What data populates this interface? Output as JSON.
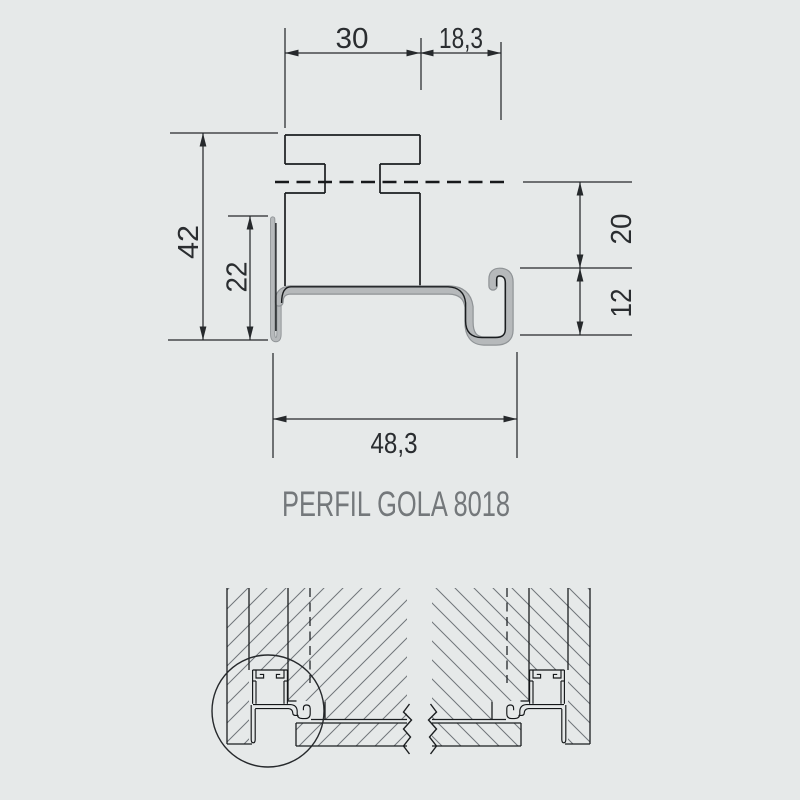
{
  "title": "PERFIL GOLA 8018",
  "drawing": {
    "dimensions": {
      "top_width_left": "30",
      "top_width_right": "18,3",
      "overall_height": "42",
      "flange_height": "22",
      "right_upper": "20",
      "right_lower": "12",
      "bottom_width": "48,3"
    }
  },
  "diagram": {
    "type": "technical-drawing",
    "units": "mm",
    "profile_name": "PERFIL GOLA 8018",
    "views": [
      "profile-cross-section",
      "installation-detail-left",
      "installation-detail-right"
    ],
    "measurements_mm": {
      "top_segment_a": 30,
      "top_segment_b": 18.3,
      "overall_height": 42,
      "front_flange_height": 22,
      "upper_right_offset": 20,
      "lower_right_offset": 12,
      "overall_width": 48.3
    }
  },
  "colors": {
    "background": "#e6e9e9",
    "line": "#26292c",
    "profile_fill": "#b6b9bb",
    "profile_edge": "#8f9396",
    "title_text": "#74787b",
    "hatch": "#70757a"
  }
}
